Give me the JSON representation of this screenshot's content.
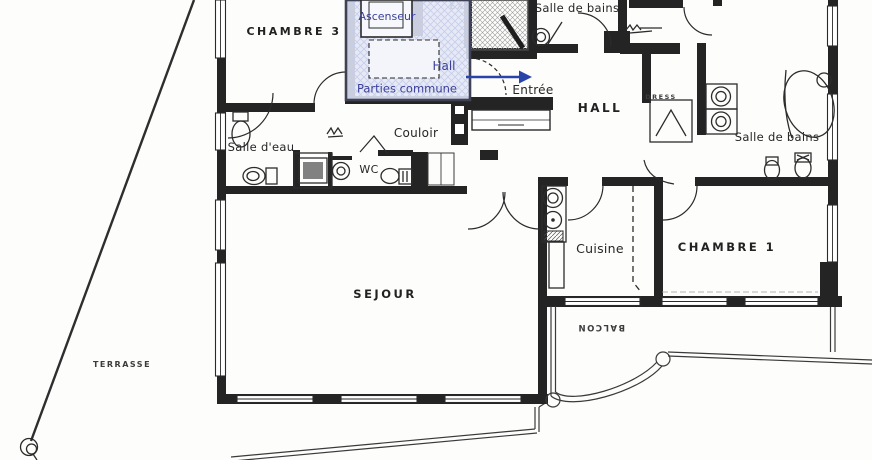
{
  "labels": {
    "chambre3": "CHAMBRE 3",
    "chambre1": "CHAMBRE 1",
    "sejour": "SEJOUR",
    "hall_main": "HALL",
    "balcon": "BALCON",
    "terrasse": "TERRASSE",
    "dress": "DRESS",
    "esc": "EX",
    "salle_de_bains_top": "Salle de bains",
    "salle_de_bains_right": "Salle de bains",
    "salle_deau": "Salle d'eau",
    "couloir": "Couloir",
    "cuisine": "Cuisine",
    "wc": "WC",
    "entree": "Entrée"
  },
  "overlay": {
    "ascenseur": "Ascenseur",
    "hall": "Hall",
    "parties_communes": "Parties commune",
    "fill_color": "#e2e6f5",
    "text_color": "#3a3f99",
    "arrow_color": "#2944a8"
  },
  "colors": {
    "ink": "#242424",
    "paper": "#fdfdfc"
  }
}
